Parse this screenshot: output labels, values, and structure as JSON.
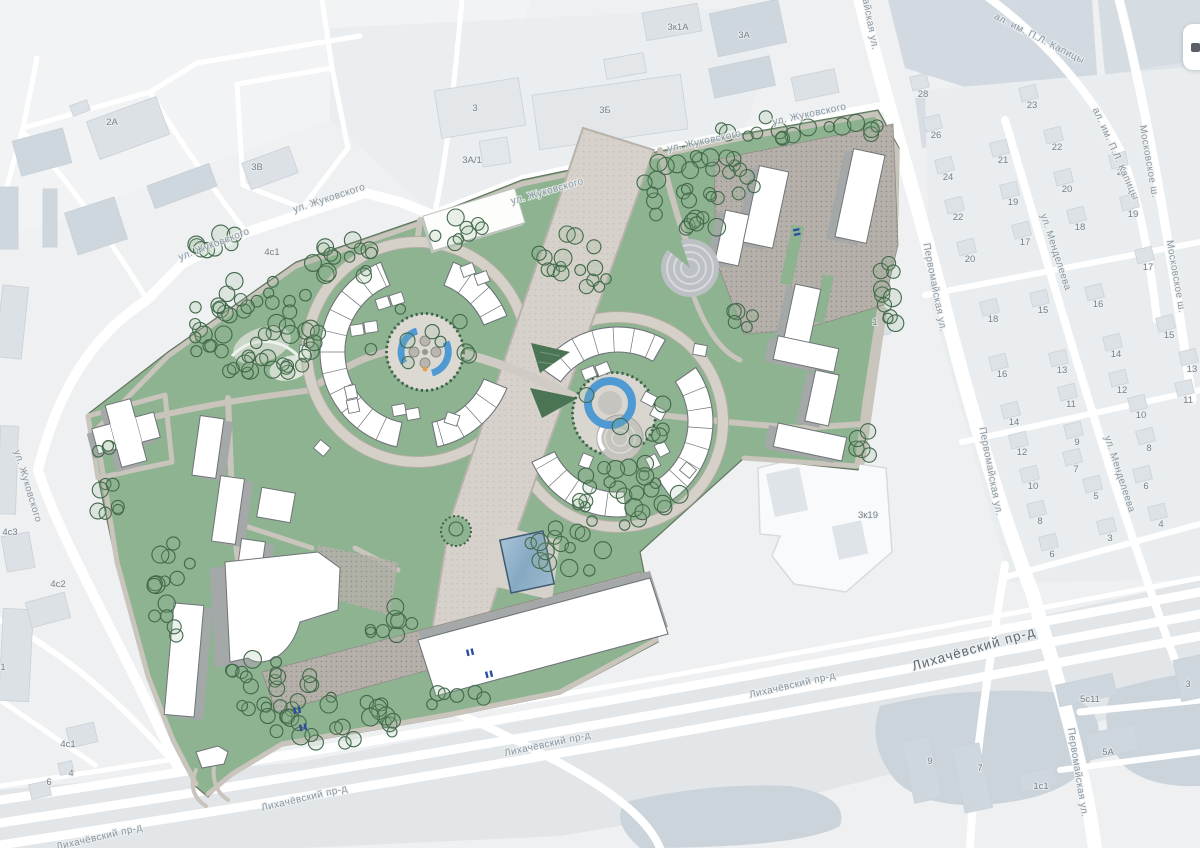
{
  "map": {
    "street_labels": [
      {
        "text": "ул. Жуковского",
        "x": 215,
        "y": 247,
        "rot": -21
      },
      {
        "text": "ул. Жуковского",
        "x": 330,
        "y": 201,
        "rot": -18
      },
      {
        "text": "ул. Жуковского",
        "x": 548,
        "y": 194,
        "rot": -16
      },
      {
        "text": "ул. Жуковского",
        "x": 705,
        "y": 144,
        "rot": -12
      },
      {
        "text": "ул. Жуковского",
        "x": 810,
        "y": 117,
        "rot": -12
      },
      {
        "text": "ул. Жуковского",
        "x": 25,
        "y": 487,
        "rot": 73
      },
      {
        "text": "Первомайская ул.",
        "x": 864,
        "y": 6,
        "rot": 79
      },
      {
        "text": "Первомайская ул.",
        "x": 932,
        "y": 288,
        "rot": 79
      },
      {
        "text": "Первомайская ул.",
        "x": 988,
        "y": 472,
        "rot": 79
      },
      {
        "text": "Первомайская ул.",
        "x": 1075,
        "y": 773,
        "rot": 81
      },
      {
        "text": "ал. им. П.Л. Капицы",
        "x": 1038,
        "y": 41,
        "rot": 27
      },
      {
        "text": "ал. им. П.Л. Капицы",
        "x": 1113,
        "y": 155,
        "rot": 66
      },
      {
        "text": "Московское ш.",
        "x": 1146,
        "y": 162,
        "rot": 80
      },
      {
        "text": "Московское ш.",
        "x": 1173,
        "y": 277,
        "rot": 80
      },
      {
        "text": "ул. Менделеева",
        "x": 1053,
        "y": 253,
        "rot": 72
      },
      {
        "text": "ул. Менделеева",
        "x": 1117,
        "y": 475,
        "rot": 72
      },
      {
        "text": "Лихачёвский пр-д",
        "x": 975,
        "y": 653,
        "rot": -16,
        "size": "big"
      },
      {
        "text": "Лихачёвский пр-д",
        "x": 793,
        "y": 688,
        "rot": -13
      },
      {
        "text": "Лихачёвский пр-д",
        "x": 548,
        "y": 747,
        "rot": -12
      },
      {
        "text": "Лихачёвский пр-д",
        "x": 305,
        "y": 801,
        "rot": -13
      },
      {
        "text": "Лихачёвский пр-д",
        "x": 100,
        "y": 840,
        "rot": -13
      }
    ],
    "house_numbers": [
      {
        "text": "2А",
        "x": 112,
        "y": 125
      },
      {
        "text": "3В",
        "x": 257,
        "y": 170
      },
      {
        "text": "4с1",
        "x": 272,
        "y": 255
      },
      {
        "text": "3к1А",
        "x": 678,
        "y": 30
      },
      {
        "text": "3А",
        "x": 744,
        "y": 38
      },
      {
        "text": "3",
        "x": 475,
        "y": 111
      },
      {
        "text": "3Б",
        "x": 605,
        "y": 113
      },
      {
        "text": "3А/1",
        "x": 472,
        "y": 163
      },
      {
        "text": "28",
        "x": 923,
        "y": 97
      },
      {
        "text": "23",
        "x": 1032,
        "y": 108
      },
      {
        "text": "26",
        "x": 936,
        "y": 138
      },
      {
        "text": "22",
        "x": 1057,
        "y": 150
      },
      {
        "text": "21",
        "x": 1003,
        "y": 163
      },
      {
        "text": "21",
        "x": 1122,
        "y": 175
      },
      {
        "text": "24",
        "x": 948,
        "y": 180
      },
      {
        "text": "20",
        "x": 1067,
        "y": 192
      },
      {
        "text": "19",
        "x": 1013,
        "y": 205
      },
      {
        "text": "19",
        "x": 1133,
        "y": 217
      },
      {
        "text": "22",
        "x": 958,
        "y": 220
      },
      {
        "text": "18",
        "x": 1080,
        "y": 230
      },
      {
        "text": "17",
        "x": 1025,
        "y": 245
      },
      {
        "text": "20",
        "x": 970,
        "y": 262
      },
      {
        "text": "17",
        "x": 1148,
        "y": 270
      },
      {
        "text": "1",
        "x": 875,
        "y": 325
      },
      {
        "text": "18",
        "x": 993,
        "y": 322
      },
      {
        "text": "15",
        "x": 1043,
        "y": 313
      },
      {
        "text": "16",
        "x": 1098,
        "y": 307
      },
      {
        "text": "15",
        "x": 1169,
        "y": 338
      },
      {
        "text": "14",
        "x": 1116,
        "y": 357
      },
      {
        "text": "16",
        "x": 1002,
        "y": 377
      },
      {
        "text": "13",
        "x": 1062,
        "y": 373
      },
      {
        "text": "13",
        "x": 1192,
        "y": 372
      },
      {
        "text": "12",
        "x": 1122,
        "y": 393
      },
      {
        "text": "11",
        "x": 1071,
        "y": 407
      },
      {
        "text": "11",
        "x": 1188,
        "y": 403
      },
      {
        "text": "10",
        "x": 1141,
        "y": 418
      },
      {
        "text": "14",
        "x": 1014,
        "y": 425
      },
      {
        "text": "9",
        "x": 1077,
        "y": 445
      },
      {
        "text": "8",
        "x": 1149,
        "y": 451
      },
      {
        "text": "12",
        "x": 1022,
        "y": 455
      },
      {
        "text": "7",
        "x": 1076,
        "y": 472
      },
      {
        "text": "10",
        "x": 1033,
        "y": 489
      },
      {
        "text": "6",
        "x": 1146,
        "y": 489
      },
      {
        "text": "5",
        "x": 1096,
        "y": 499
      },
      {
        "text": "8",
        "x": 1040,
        "y": 524
      },
      {
        "text": "4",
        "x": 1161,
        "y": 527
      },
      {
        "text": "3",
        "x": 1110,
        "y": 541
      },
      {
        "text": "6",
        "x": 1052,
        "y": 557
      },
      {
        "text": "3к19",
        "x": 868,
        "y": 518
      },
      {
        "text": "5с11",
        "x": 1090,
        "y": 702
      },
      {
        "text": "3",
        "x": 1188,
        "y": 687
      },
      {
        "text": "9",
        "x": 930,
        "y": 764
      },
      {
        "text": "7",
        "x": 980,
        "y": 771
      },
      {
        "text": "5А",
        "x": 1108,
        "y": 755
      },
      {
        "text": "1с1",
        "x": 1041,
        "y": 789
      },
      {
        "text": "4с2",
        "x": 58,
        "y": 587
      },
      {
        "text": "4с1",
        "x": 68,
        "y": 747
      },
      {
        "text": "4",
        "x": 71,
        "y": 776
      },
      {
        "text": "6",
        "x": 49,
        "y": 785
      },
      {
        "text": "4с3",
        "x": 10,
        "y": 535
      },
      {
        "text": "4с1",
        "x": -2,
        "y": 670
      }
    ],
    "colors": {
      "map_bg": "#eef0f2",
      "map_block": "#e7ebee",
      "map_building": "#dce1e6",
      "map_building_dark": "#cfd7de",
      "road_white": "#ffffff",
      "label_gray": "#8b95a1",
      "label_dark": "#5f6873",
      "plan_green": "#8db391",
      "plan_path": "#d6d2cb",
      "plan_parking": "#b5b1aa",
      "tree_green": "#43684b",
      "water_blue": "#4f9ad3",
      "building_white": "#ffffff",
      "building_shadow": "#a5a8a8",
      "outline": "#6f7478"
    }
  }
}
